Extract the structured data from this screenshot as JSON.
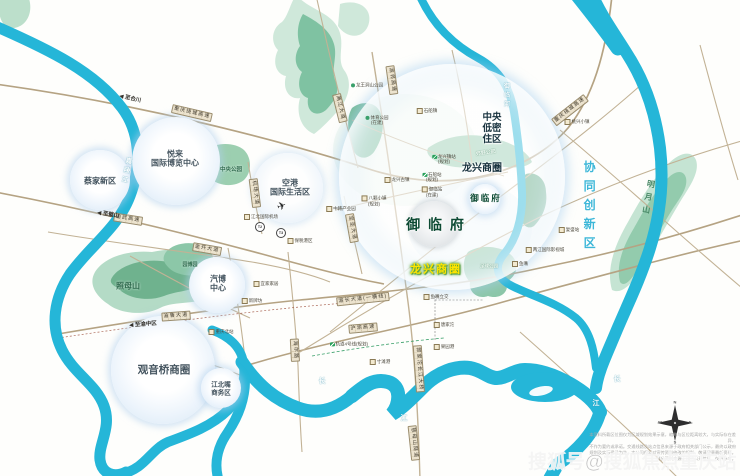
{
  "map": {
    "watermark": "搜狐号@搜狐焦点重庆站",
    "disclaimer": [
      "本资料所载区位图仅为区域规划效果示意，缩略与区位距离较大，与实际存在差异，",
      "不作为要约或承诺。交通线路及站点信息来源于政府相关部门公示，最终以政府",
      "规划及实际建设为准。本公司保留对宣传资料修改的权利，敬请留意最新资料。",
      "部分资料来源于网络公开信息，仅供参考。"
    ],
    "compass": {
      "n": "N",
      "e": "E",
      "s": "S",
      "w": "W"
    },
    "colors": {
      "river": "#25b6d8",
      "road": "#c2b295",
      "highway": "#b5a383",
      "mountain": "#7fc2a2",
      "highlight_text": "#ffe400",
      "district_text": "#17313d",
      "project_text": "#0d4a33",
      "synergy_text": "#3db7d8"
    },
    "labels": [
      {
        "n": "label-central-lowdensity",
        "t": "中央\n低密\n住区",
        "x": 492,
        "y": 129,
        "c": "dist",
        "s": 9.5
      },
      {
        "n": "label-longxing-district",
        "t": "龙兴商圈",
        "x": 482,
        "y": 169,
        "c": "dist",
        "s": 10
      },
      {
        "n": "label-synergy-zone",
        "t": "协同创新区",
        "x": 589,
        "y": 208,
        "c": "syn",
        "s": 12
      },
      {
        "n": "label-yulinfu-main",
        "t": "御 临 府",
        "x": 436,
        "y": 225,
        "c": "proj",
        "s": 14
      },
      {
        "n": "label-yulinfu-small",
        "t": "御临府",
        "x": 486,
        "y": 198,
        "c": "proj",
        "s": 8.5
      },
      {
        "n": "label-longxing-highlight",
        "t": "龙兴商圈",
        "x": 436,
        "y": 270,
        "c": "highlight",
        "s": 11
      },
      {
        "n": "label-caijia",
        "t": "蔡家新区",
        "x": 100,
        "y": 181,
        "c": "bub",
        "s": 8
      },
      {
        "n": "label-yuelai-expo",
        "t": "悦来\n国际博览中心",
        "x": 175,
        "y": 159,
        "c": "bub",
        "s": 8
      },
      {
        "n": "label-konggang",
        "t": "空港\n国际生活区",
        "x": 290,
        "y": 188,
        "c": "bub",
        "s": 8
      },
      {
        "n": "label-qibo",
        "t": "汽博\n中心",
        "x": 218,
        "y": 284,
        "c": "bub",
        "s": 8
      },
      {
        "n": "label-guanyinqiao",
        "t": "观音桥商圈",
        "x": 164,
        "y": 370,
        "c": "bub",
        "s": 10.5
      },
      {
        "n": "label-jiangbeizui",
        "t": "江北嘴\n商务区",
        "x": 221,
        "y": 389,
        "c": "bub",
        "s": 6.5
      },
      {
        "n": "label-zhaomushan",
        "t": "照母山",
        "x": 128,
        "y": 286,
        "c": "mtn",
        "s": 8
      },
      {
        "n": "label-yuanboyuan",
        "t": "园博园",
        "x": 190,
        "y": 266,
        "c": "mtn",
        "s": 5
      },
      {
        "n": "label-central-park",
        "t": "中央公园",
        "x": 231,
        "y": 170,
        "c": "mtn",
        "s": 5.5
      },
      {
        "n": "label-mingyueshan",
        "t": "明月山",
        "x": 648,
        "y": 199,
        "c": "mtn-v",
        "s": 8,
        "r": 10
      },
      {
        "n": "label-country-park",
        "t": "郊野公园",
        "x": 486,
        "y": 154,
        "c": "mtn-w",
        "s": 5,
        "r": -8
      },
      {
        "n": "label-football-park",
        "t": "足球公园",
        "x": 489,
        "y": 266,
        "c": "mtn-w",
        "s": 4.5
      },
      {
        "n": "label-jialingjiang",
        "t": "嘉陵江",
        "x": 125,
        "y": 171,
        "c": "riv vert",
        "s": 6.5,
        "r": 12
      },
      {
        "n": "label-yulinhe",
        "t": "御临河",
        "x": 505,
        "y": 96,
        "c": "riv vert",
        "s": 6
      },
      {
        "n": "label-changjiang-1",
        "t": "长",
        "x": 322,
        "y": 382,
        "c": "riv",
        "s": 7
      },
      {
        "n": "label-changjiang-2",
        "t": "江",
        "x": 404,
        "y": 419,
        "c": "riv",
        "s": 7
      },
      {
        "n": "label-changjiang-3",
        "t": "长",
        "x": 617,
        "y": 380,
        "c": "riv",
        "s": 7
      },
      {
        "n": "label-changjiang-4",
        "t": "江",
        "x": 596,
        "y": 404,
        "c": "riv",
        "s": 7
      },
      {
        "n": "road-raocheng-west",
        "t": "重庆绕城高速",
        "x": 192,
        "y": 113,
        "c": "road",
        "r": 13
      },
      {
        "n": "road-yuwu",
        "t": "渝武高速",
        "x": 128,
        "y": 219,
        "c": "road",
        "r": 9
      },
      {
        "n": "road-jinkai",
        "t": "金开大道",
        "x": 207,
        "y": 249,
        "c": "road",
        "r": 10
      },
      {
        "n": "road-yulu",
        "t": "渝鲁大道",
        "x": 176,
        "y": 316,
        "c": "road",
        "r": -4
      },
      {
        "n": "road-haier",
        "t": "海尔路",
        "x": 295,
        "y": 350,
        "c": "road",
        "r": 87
      },
      {
        "n": "road-jichang",
        "t": "机场大道",
        "x": 255,
        "y": 193,
        "c": "road",
        "r": 83
      },
      {
        "n": "road-baosheng",
        "t": "宝圣大道",
        "x": 352,
        "y": 228,
        "c": "road",
        "r": 80
      },
      {
        "n": "road-liangjiang",
        "t": "两江大道",
        "x": 340,
        "y": 108,
        "c": "road",
        "r": 76
      },
      {
        "n": "road-yulin-exp",
        "t": "渝邻高速",
        "x": 392,
        "y": 80,
        "c": "road",
        "r": 82
      },
      {
        "n": "road-raocheng-east",
        "t": "重庆绕城高速",
        "x": 570,
        "y": 110,
        "c": "road",
        "r": -38
      },
      {
        "n": "road-yuchang",
        "t": "渝长大道(一横线)",
        "x": 363,
        "y": 299,
        "c": "road",
        "r": -6
      },
      {
        "n": "road-huyu",
        "t": "沪渝高速",
        "x": 363,
        "y": 328,
        "c": "road",
        "r": -5
      },
      {
        "n": "road-guojiatuo-bridge",
        "t": "郭家沱长江大桥",
        "x": 419,
        "y": 369,
        "c": "road",
        "r": 86
      },
      {
        "n": "road-cimushan-tunnel",
        "t": "慈母山隧道",
        "x": 414,
        "y": 443,
        "c": "road",
        "r": 84
      },
      {
        "n": "arrow-to-hechuan",
        "t": "◀ 至合川",
        "x": 130,
        "y": 99,
        "c": "arr",
        "r": 13
      },
      {
        "n": "arrow-to-bishan",
        "t": "◀ 至璧山",
        "x": 108,
        "y": 215,
        "c": "arr",
        "r": 9
      },
      {
        "n": "arrow-to-yuzhong",
        "t": "◀ 至渝中区",
        "x": 143,
        "y": 325,
        "c": "arr",
        "r": -4
      },
      {
        "n": "poi-longxingzhen-station",
        "t": "龙兴镇站\n(规划)",
        "x": 444,
        "y": 159,
        "c": "metro"
      },
      {
        "n": "poi-shichuan-station",
        "t": "石船站\n(规划)",
        "x": 432,
        "y": 177,
        "c": "metro"
      },
      {
        "n": "poi-longxing-ancient-town",
        "t": "龙兴古镇",
        "x": 397,
        "y": 180,
        "c": "poi"
      },
      {
        "n": "poi-bake-town",
        "t": "八颗小镇\n(规划)",
        "x": 374,
        "y": 201,
        "c": "poi"
      },
      {
        "n": "poi-yulin-station",
        "t": "御临站\n(在建)",
        "x": 432,
        "y": 192,
        "c": "poi"
      },
      {
        "n": "poi-sports-park",
        "t": "体育公园\n(在建)",
        "x": 377,
        "y": 120,
        "c": "poi-green"
      },
      {
        "n": "poi-shichuan-town",
        "t": "石船镇",
        "x": 427,
        "y": 111,
        "c": "poi"
      },
      {
        "n": "poi-taoxing-town",
        "t": "桃兴小镇",
        "x": 577,
        "y": 122,
        "c": "poi"
      },
      {
        "n": "poi-fusheng-station",
        "t": "复盛站",
        "x": 569,
        "y": 230,
        "c": "poi"
      },
      {
        "n": "poi-film-city",
        "t": "两江国际影视城",
        "x": 545,
        "y": 250,
        "c": "poi"
      },
      {
        "n": "poi-yuzui",
        "t": "鱼嘴",
        "x": 520,
        "y": 264,
        "c": "poi"
      },
      {
        "n": "poi-yuzui-interchange",
        "t": "鱼嘴立交",
        "x": 436,
        "y": 297,
        "c": "poi"
      },
      {
        "n": "poi-tangjiatuo",
        "t": "唐家沱",
        "x": 444,
        "y": 325,
        "c": "poi"
      },
      {
        "n": "poi-guoyuan-port",
        "t": "果园港",
        "x": 444,
        "y": 347,
        "c": "poi"
      },
      {
        "n": "poi-cuntan-port",
        "t": "寸滩港",
        "x": 380,
        "y": 362,
        "c": "poi"
      },
      {
        "n": "poi-metro-line4",
        "t": "轨道4号线(规划)",
        "x": 349,
        "y": 344,
        "c": "metro"
      },
      {
        "n": "poi-chongqing-north-station",
        "t": "重庆北站",
        "x": 221,
        "y": 332,
        "c": "poi"
      },
      {
        "n": "poi-ikea",
        "t": "宜家家居",
        "x": 266,
        "y": 284,
        "c": "poi"
      },
      {
        "n": "poi-xinpaifang",
        "t": "新牌坊",
        "x": 252,
        "y": 301,
        "c": "poi"
      },
      {
        "n": "poi-bonded-port",
        "t": "保税港区",
        "x": 300,
        "y": 241,
        "c": "poi"
      },
      {
        "n": "poi-zhonghan-park",
        "t": "中韩产业园",
        "x": 341,
        "y": 209,
        "c": "poi"
      },
      {
        "n": "poi-longwangdong-park",
        "t": "龙王洞山公园",
        "x": 367,
        "y": 85,
        "c": "poi-green"
      },
      {
        "n": "label-jiangbei-airport",
        "t": "江北国际机场",
        "x": 261,
        "y": 217,
        "c": "poi"
      },
      {
        "n": "airport-plane-icon",
        "t": "✈",
        "x": 282,
        "y": 207,
        "c": "plane",
        "s": 11,
        "r": -20
      },
      {
        "n": "airport-t2-badge",
        "t": "T2",
        "x": 260,
        "y": 227,
        "c": "tcircle"
      },
      {
        "n": "airport-t3-badge",
        "t": "T3",
        "x": 281,
        "y": 233,
        "c": "tcircle"
      }
    ]
  }
}
